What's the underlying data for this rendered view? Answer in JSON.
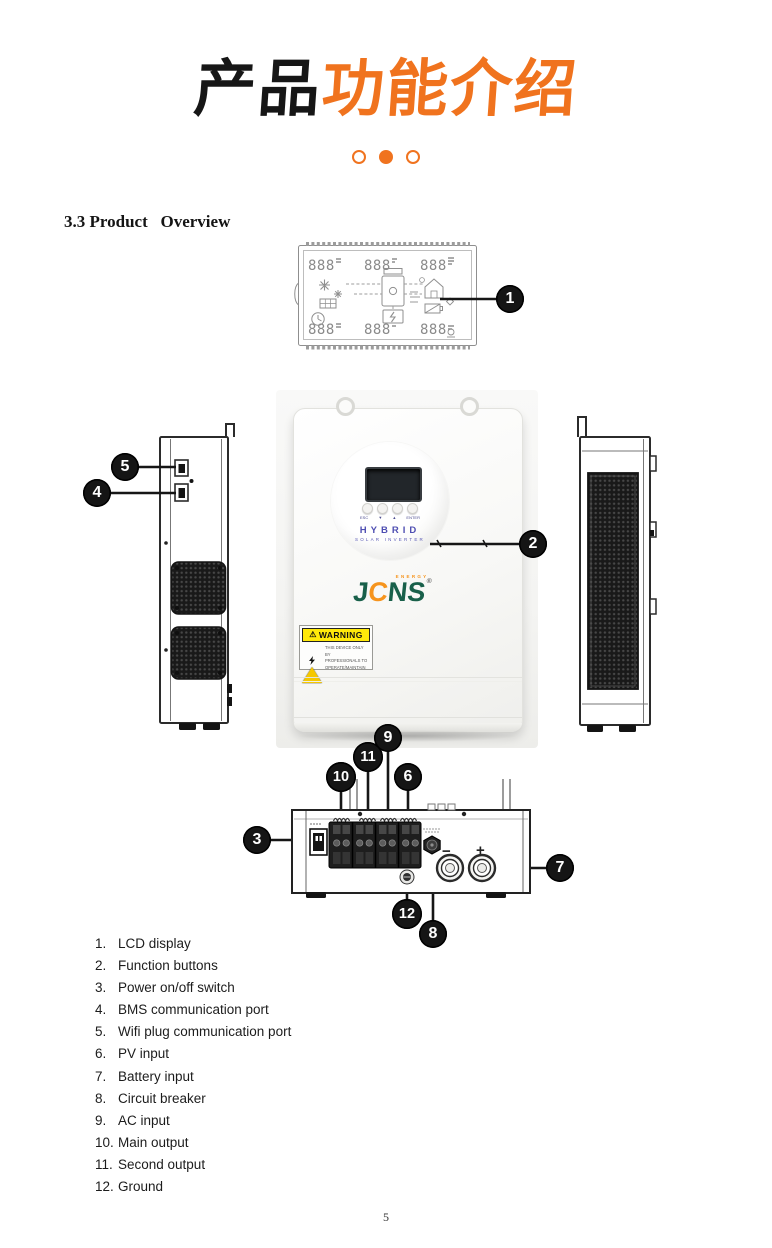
{
  "header": {
    "title_black": "产品",
    "title_orange": "功能介绍",
    "dots": [
      "circle-outline",
      "circle-filled",
      "circle-outline"
    ]
  },
  "section": {
    "heading": "3.3 Product   Overview"
  },
  "lcd_diagram": {
    "digits": [
      "888",
      "888",
      "888",
      "888",
      "888",
      "888"
    ]
  },
  "front_view": {
    "buttons": [
      "ESC",
      "▼",
      "▲",
      "ENTER"
    ],
    "brand_title": "HYBRID",
    "brand_subtitle": "SOLAR INVERTER",
    "logo": {
      "j": "J",
      "c": "C",
      "ns": "NS",
      "energy": "ENERGY",
      "registered": "®"
    },
    "warning": {
      "title": "WARNING",
      "lines": [
        "THIS DEVICE ONLY BY",
        "PROFESSIONALS TO",
        "OPERATE/MAINTAIN"
      ]
    }
  },
  "bottom_view": {
    "battery_minus": "−",
    "battery_plus": "+"
  },
  "callouts": {
    "labels": [
      "1",
      "2",
      "3",
      "4",
      "5",
      "6",
      "7",
      "8",
      "9",
      "10",
      "11",
      "12"
    ]
  },
  "legend": {
    "items": [
      {
        "num": "1.",
        "label": "LCD display"
      },
      {
        "num": "2.",
        "label": "Function buttons"
      },
      {
        "num": "3.",
        "label": "Power on/off switch"
      },
      {
        "num": "4.",
        "label": "BMS communication port"
      },
      {
        "num": "5.",
        "label": "Wifi plug communication port"
      },
      {
        "num": "6.",
        "label": "PV input"
      },
      {
        "num": "7.",
        "label": "Battery input"
      },
      {
        "num": "8.",
        "label": "Circuit breaker"
      },
      {
        "num": "9.",
        "label": "AC input"
      },
      {
        "num": "10.",
        "label": "Main output"
      },
      {
        "num": "11.",
        "label": "Second output"
      },
      {
        "num": "12.",
        "label": "Ground"
      }
    ]
  },
  "footer": {
    "page_number": "5"
  }
}
